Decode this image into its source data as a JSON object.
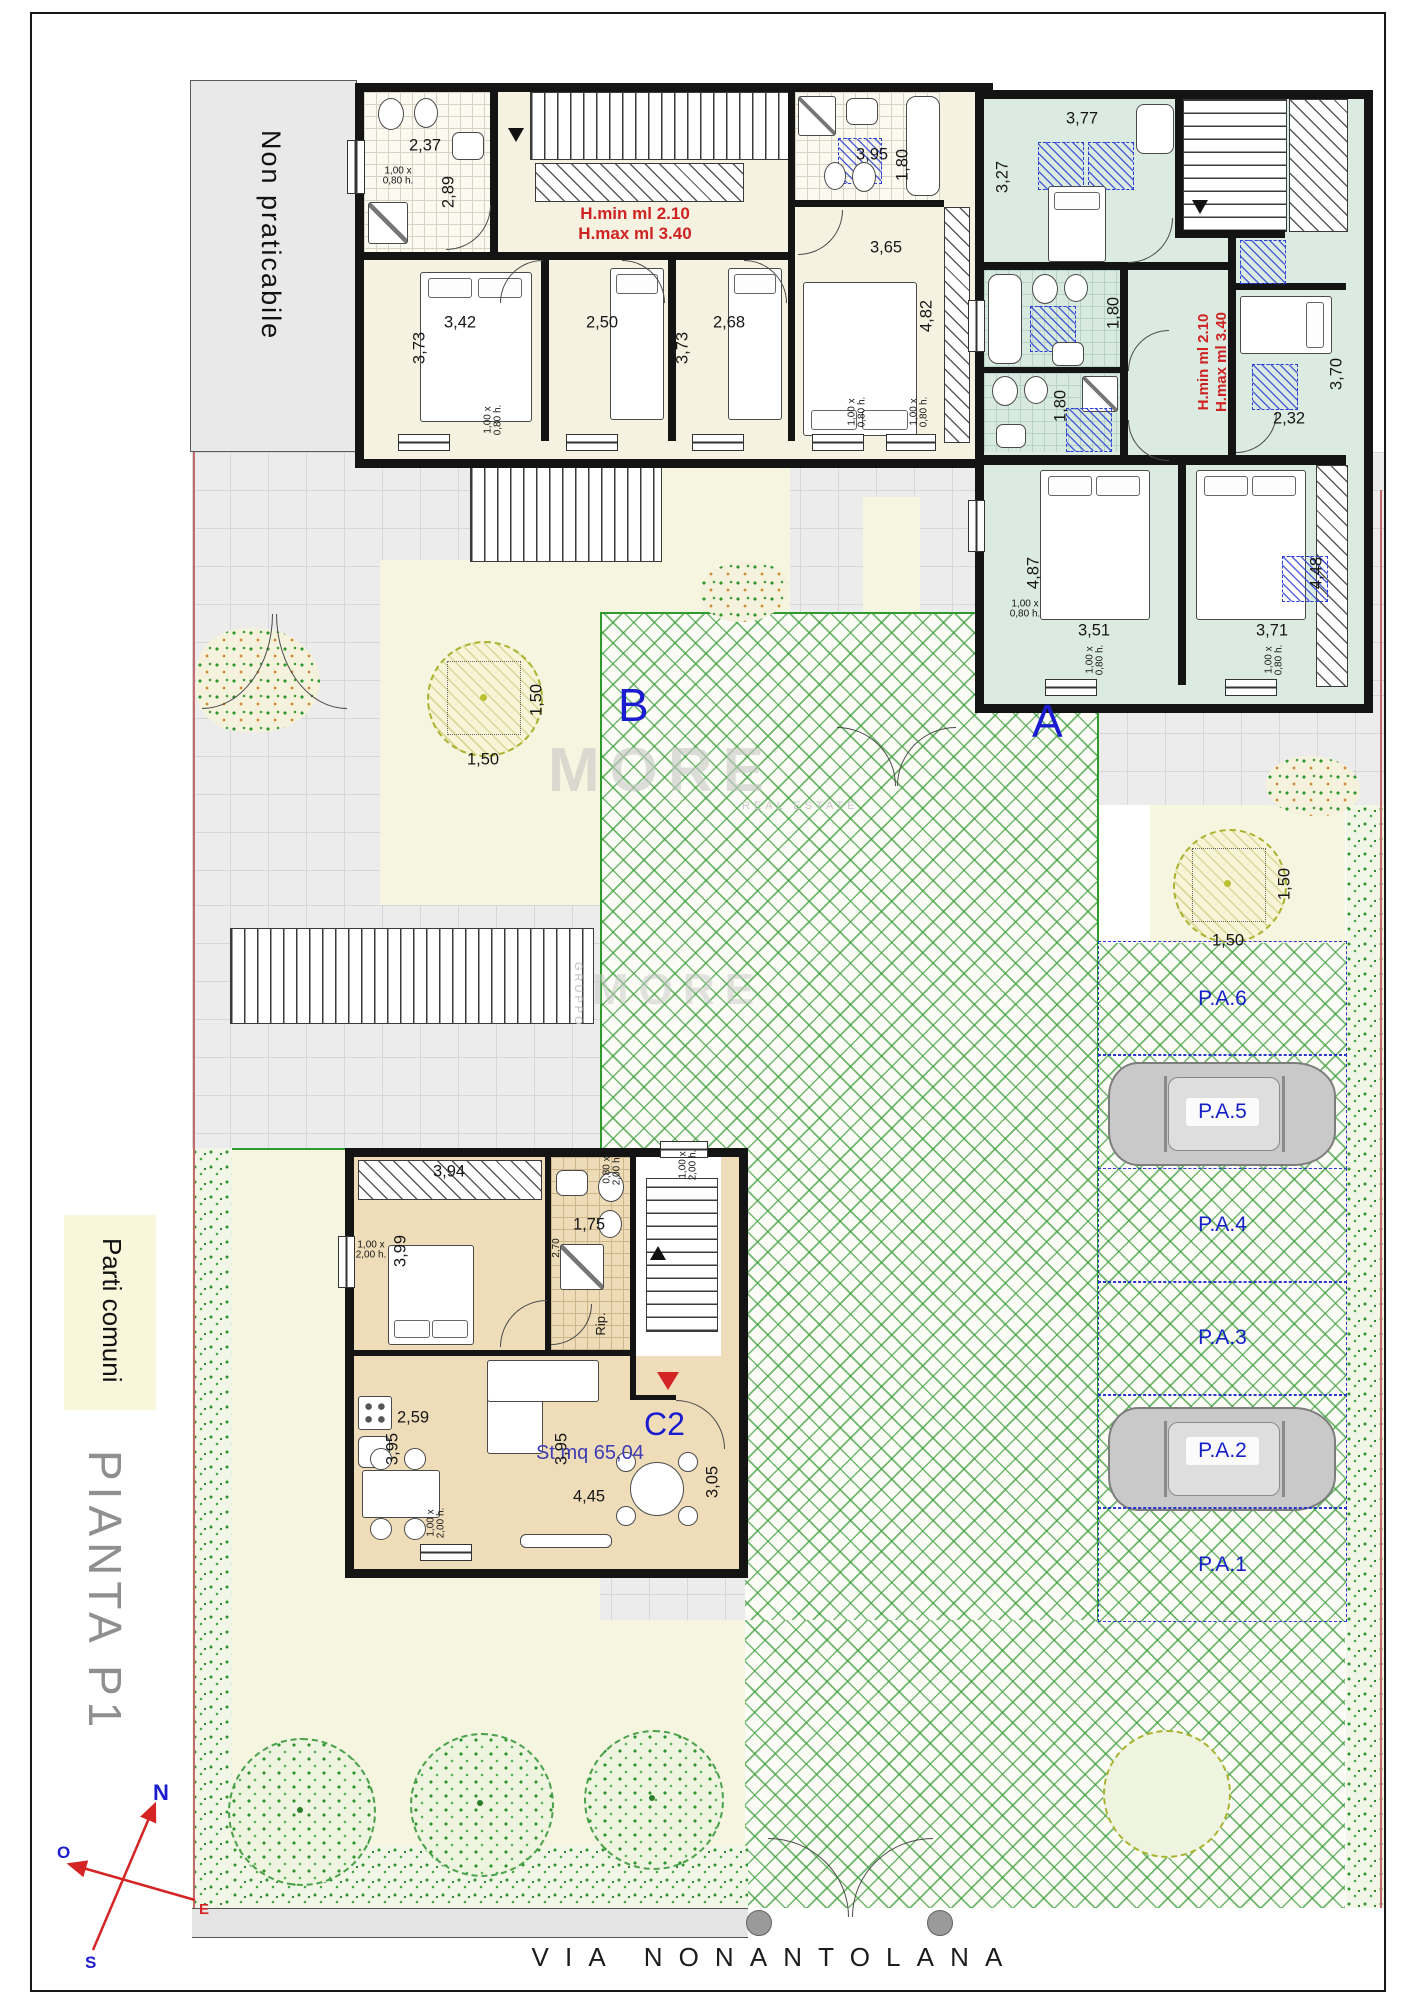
{
  "page": {
    "street": "VIA NONANTOLANA",
    "plan_title": "PIANTA P1",
    "legend_common": "Parti comuni",
    "non_walkable": "Non praticabile"
  },
  "units": {
    "a": "A",
    "b": "B",
    "c2": "C2",
    "c2_surface": "St mq 65,04",
    "storage": "Rip."
  },
  "height_note": {
    "l1": "H.min ml 2.10",
    "l2": "H.max ml 3.40"
  },
  "compass": {
    "n": "N",
    "o": "O",
    "e": "E",
    "s": "S"
  },
  "watermark": {
    "brand": "MORE",
    "sub": "REAL ESTATE",
    "group": "GRUPPO"
  },
  "parking": {
    "stalls": [
      "P.A.6",
      "P.A.5",
      "P.A.4",
      "P.A.3",
      "P.A.2",
      "P.A.1"
    ],
    "car_stalls": [
      "P.A.5",
      "P.A.2"
    ]
  },
  "colors": {
    "accent_blue": "#1b1bd0",
    "note_red": "#cf2222",
    "terrace_green": "#2f9b2f",
    "teal_room": "#dcebe2",
    "cream_room": "#f5f2e2",
    "tan_room": "#efddba"
  },
  "dims": [
    {
      "t": "2,37",
      "x": 425,
      "y": 146
    },
    {
      "t": "2,89",
      "x": 449,
      "y": 192,
      "r": 1
    },
    {
      "t": "1,00 x\n0,80 h.",
      "x": 398,
      "y": 177,
      "sm": 1
    },
    {
      "t": "3,95",
      "x": 872,
      "y": 155
    },
    {
      "t": "1,80",
      "x": 903,
      "y": 165,
      "r": 1
    },
    {
      "t": "3,42",
      "x": 460,
      "y": 323
    },
    {
      "t": "3,73",
      "x": 420,
      "y": 348,
      "r": 1
    },
    {
      "t": "2,50",
      "x": 602,
      "y": 323
    },
    {
      "t": "3,73",
      "x": 683,
      "y": 348,
      "r": 1
    },
    {
      "t": "2,68",
      "x": 729,
      "y": 323
    },
    {
      "t": "3,65",
      "x": 886,
      "y": 248
    },
    {
      "t": "4,82",
      "x": 927,
      "y": 316,
      "r": 1
    },
    {
      "t": "1,00 x\n0,80 h.",
      "x": 494,
      "y": 420,
      "r": 1,
      "sm": 1
    },
    {
      "t": "1,00 x\n0,80 h.",
      "x": 858,
      "y": 412,
      "r": 1,
      "sm": 1
    },
    {
      "t": "1,00 x\n0,80 h.",
      "x": 920,
      "y": 412,
      "r": 1,
      "sm": 1
    },
    {
      "t": "3,77",
      "x": 1082,
      "y": 119
    },
    {
      "t": "3,27",
      "x": 1003,
      "y": 177,
      "r": 1
    },
    {
      "t": "1,80",
      "x": 1114,
      "y": 313,
      "r": 1
    },
    {
      "t": "1,80",
      "x": 1061,
      "y": 406,
      "r": 1
    },
    {
      "t": "2,32",
      "x": 1289,
      "y": 419
    },
    {
      "t": "3,70",
      "x": 1337,
      "y": 374,
      "r": 1
    },
    {
      "t": "4,87",
      "x": 1034,
      "y": 573,
      "r": 1
    },
    {
      "t": "1,00 x\n0,80 h.",
      "x": 1025,
      "y": 610,
      "sm": 1
    },
    {
      "t": "3,51",
      "x": 1094,
      "y": 631
    },
    {
      "t": "3,71",
      "x": 1272,
      "y": 631
    },
    {
      "t": "4,48",
      "x": 1317,
      "y": 573,
      "r": 1
    },
    {
      "t": "1,00 x\n0,80 h.",
      "x": 1096,
      "y": 660,
      "r": 1,
      "sm": 1
    },
    {
      "t": "1,00 x\n0,80 h.",
      "x": 1275,
      "y": 660,
      "r": 1,
      "sm": 1
    },
    {
      "t": "1,50",
      "x": 483,
      "y": 760
    },
    {
      "t": "1,50",
      "x": 537,
      "y": 700,
      "r": 1
    },
    {
      "t": "1,50",
      "x": 1228,
      "y": 941
    },
    {
      "t": "1,50",
      "x": 1285,
      "y": 884,
      "r": 1
    },
    {
      "t": "3,94",
      "x": 449,
      "y": 1172
    },
    {
      "t": "3,99",
      "x": 401,
      "y": 1251,
      "r": 1
    },
    {
      "t": "1,00 x\n2,00 h.",
      "x": 371,
      "y": 1251,
      "sm": 1
    },
    {
      "t": "2,70",
      "x": 557,
      "y": 1248,
      "r": 1,
      "sm": 1
    },
    {
      "t": "1,75",
      "x": 589,
      "y": 1225
    },
    {
      "t": "0,80 x\n2,00 h.",
      "x": 613,
      "y": 1170,
      "r": 1,
      "sm": 1
    },
    {
      "t": "1,00 x\n2,00 h.",
      "x": 689,
      "y": 1165,
      "r": 1,
      "sm": 1
    },
    {
      "t": "2,59",
      "x": 413,
      "y": 1418
    },
    {
      "t": "3,95",
      "x": 393,
      "y": 1449,
      "r": 1
    },
    {
      "t": "1,00 x\n2,00 h.",
      "x": 437,
      "y": 1523,
      "r": 1,
      "sm": 1
    },
    {
      "t": "3,95",
      "x": 562,
      "y": 1449,
      "r": 1
    },
    {
      "t": "4,45",
      "x": 589,
      "y": 1497
    },
    {
      "t": "3,05",
      "x": 713,
      "y": 1482,
      "r": 1
    }
  ]
}
